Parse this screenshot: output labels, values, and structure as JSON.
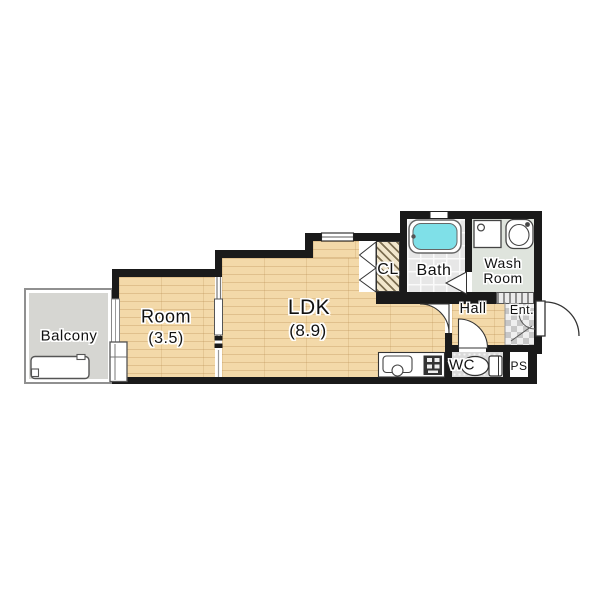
{
  "rooms": {
    "balcony": {
      "label": "Balcony"
    },
    "room": {
      "label": "Room",
      "size": "(3.5)"
    },
    "ldk": {
      "label": "LDK",
      "size": "(8.9)"
    },
    "closet": {
      "label": "CL"
    },
    "bath": {
      "label": "Bath"
    },
    "wash_room": {
      "line1": "Wash",
      "line2": "Room"
    },
    "hall": {
      "label": "Hall"
    },
    "entrance": {
      "label": "Ent."
    },
    "wc": {
      "label": "WC"
    },
    "pipe_space": {
      "label": "PS"
    }
  },
  "fixtures": [
    "bathtub",
    "washing-machine-space",
    "wash-basin",
    "toilet",
    "kitchen-sink",
    "gas-stove",
    "washer-pan",
    "entrance-door",
    "closet-folding-door",
    "bath-folding-door"
  ],
  "colors": {
    "wall": "#1a1a1a",
    "wood_floor": "#f3d9a9",
    "balcony_floor": "#d6d6d2",
    "bath_floor": "#e7e7e7",
    "wash_room_floor": "#dfe4dd",
    "bathtub": "#7fe0e8",
    "tile_dark": "#c7c7c7",
    "background": "#ffffff"
  }
}
